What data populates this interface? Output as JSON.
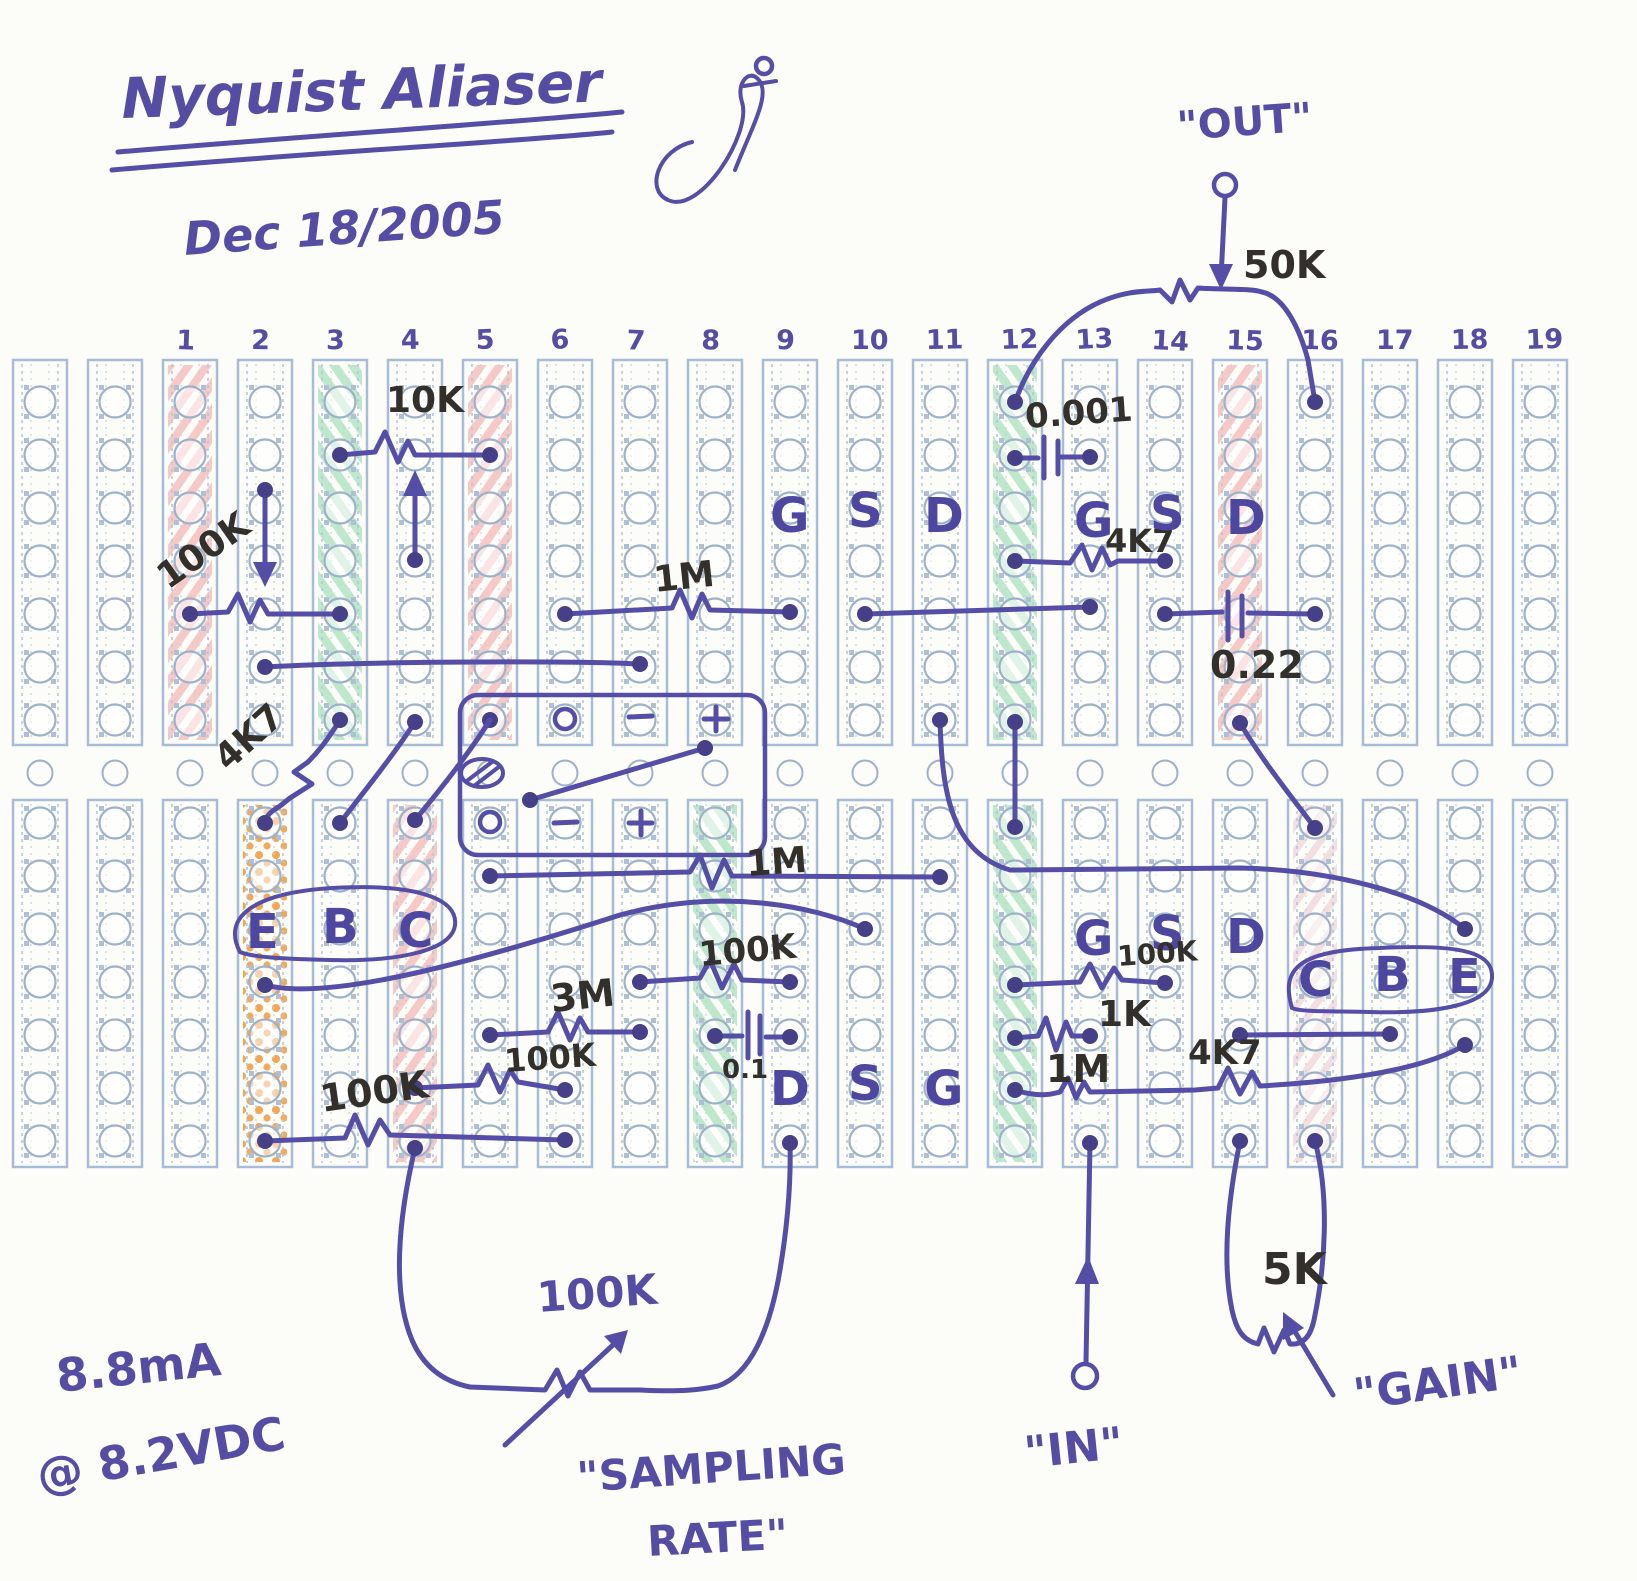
{
  "title_block": {
    "title": "Nyquist Aliaser",
    "date": "Dec 18/2005"
  },
  "board": {
    "print_color": "#a7bcd6",
    "ink_color": "#544da3",
    "marker_color": "#33302c",
    "highlight_colors": {
      "pink": "#f19f9f",
      "green": "#7fd3a0",
      "orange": "#ef9636",
      "lightpink": "#e9bcc8"
    },
    "columns": [
      {
        "num": ""
      },
      {
        "num": ""
      },
      {
        "num": "1",
        "top": "pink"
      },
      {
        "num": "2",
        "bottom": "orange"
      },
      {
        "num": "3",
        "top": "green"
      },
      {
        "num": "4",
        "bottom": "pink"
      },
      {
        "num": "5",
        "top": "pink"
      },
      {
        "num": "6"
      },
      {
        "num": "7"
      },
      {
        "num": "8",
        "bottom": "green"
      },
      {
        "num": "9"
      },
      {
        "num": "10"
      },
      {
        "num": "11"
      },
      {
        "num": "12",
        "top": "green",
        "bottom": "green"
      },
      {
        "num": "13"
      },
      {
        "num": "14"
      },
      {
        "num": "15",
        "top": "pink"
      },
      {
        "num": "16",
        "bottom": "lightpink"
      },
      {
        "num": "17"
      },
      {
        "num": "18"
      },
      {
        "num": "19"
      }
    ]
  },
  "labels": {
    "terminals": {
      "out": "\"OUT\"",
      "in": "\"IN\"",
      "gain": "\"GAIN\"",
      "sampling1": "\"SAMPLING",
      "sampling2": "RATE\""
    },
    "power": {
      "current": "8.8mA",
      "voltage": "@ 8.2VDC"
    },
    "components": {
      "r10k": "10K",
      "r100k_pot": "100K",
      "r50k": "50K",
      "c0001": "0.001",
      "r4k7_top": "4K7",
      "c022": "0.22",
      "r1m_top": "1M",
      "r4k7_mid": "4K7",
      "r1m_bot": "1M",
      "r100k_mid": "100K",
      "r3m": "3M",
      "c01": "0.1",
      "r100k_a": "100K",
      "r100k_b": "100K",
      "r100k_right": "100K",
      "r1k": "1K",
      "r1m_right": "1M",
      "r4k7_right": "4K7",
      "r5k": "5K",
      "r100k_sampling": "100K"
    },
    "pins": {
      "fet1": {
        "g": "G",
        "s": "S",
        "d": "D"
      },
      "fet2": {
        "g": "G",
        "s": "S",
        "d": "D"
      },
      "fet3": {
        "d": "D",
        "s": "S",
        "g": "G"
      },
      "fet4": {
        "g": "G",
        "s": "S",
        "d": "D"
      },
      "bjt1": {
        "e": "E",
        "b": "B",
        "c": "C"
      },
      "bjt2": {
        "c": "C",
        "b": "B",
        "e": "E"
      }
    },
    "opamp": {
      "o_top": "o",
      "minus_top": "−",
      "plus_top": "+",
      "o_bot": "o",
      "minus_bot": "−",
      "plus_bot": "+"
    }
  }
}
